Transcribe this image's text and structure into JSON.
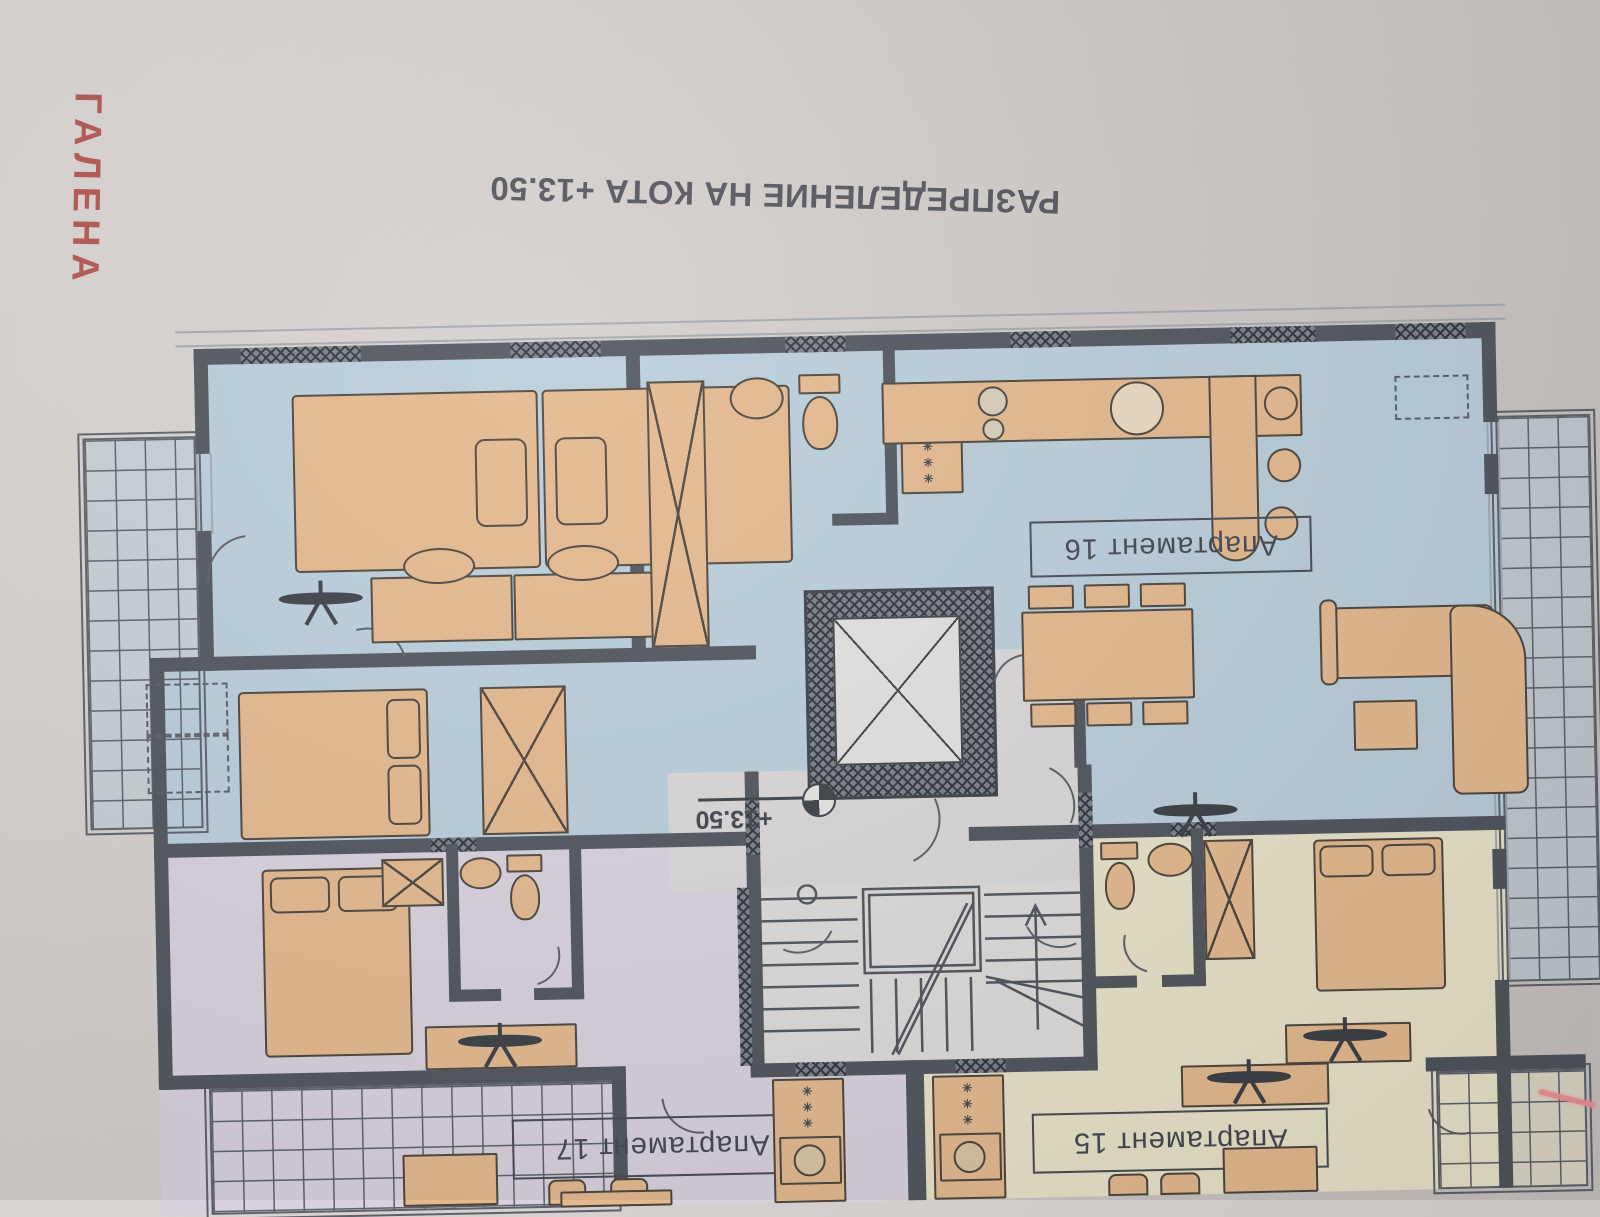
{
  "watermark": {
    "text": "ГАЛЕНА",
    "color": "#b2554e"
  },
  "title": {
    "text": "РАЗПРЕДЕЛЕНИЕ НА КОТА  +13.50"
  },
  "level_marker": {
    "text": "+13.50"
  },
  "apartments": [
    {
      "number": "16",
      "label": "Апартамент 16",
      "fill": "#b9cedb"
    },
    {
      "number": "17",
      "label": "Апартамент 17",
      "fill": "#d9d2de"
    },
    {
      "number": "15",
      "label": "Апартамент 15",
      "fill": "#e9e3c9"
    }
  ],
  "symbols": {
    "washer_marks": "✳✳✳"
  },
  "palette": {
    "wall": "#4f545c",
    "furniture": "#e4b98e",
    "paper": "#d2cdca",
    "core_gray": "#dad7d8",
    "stair_gray": "#dedbdb",
    "balcony_line": "#5b6169",
    "red_mark": "#ef8f95"
  }
}
